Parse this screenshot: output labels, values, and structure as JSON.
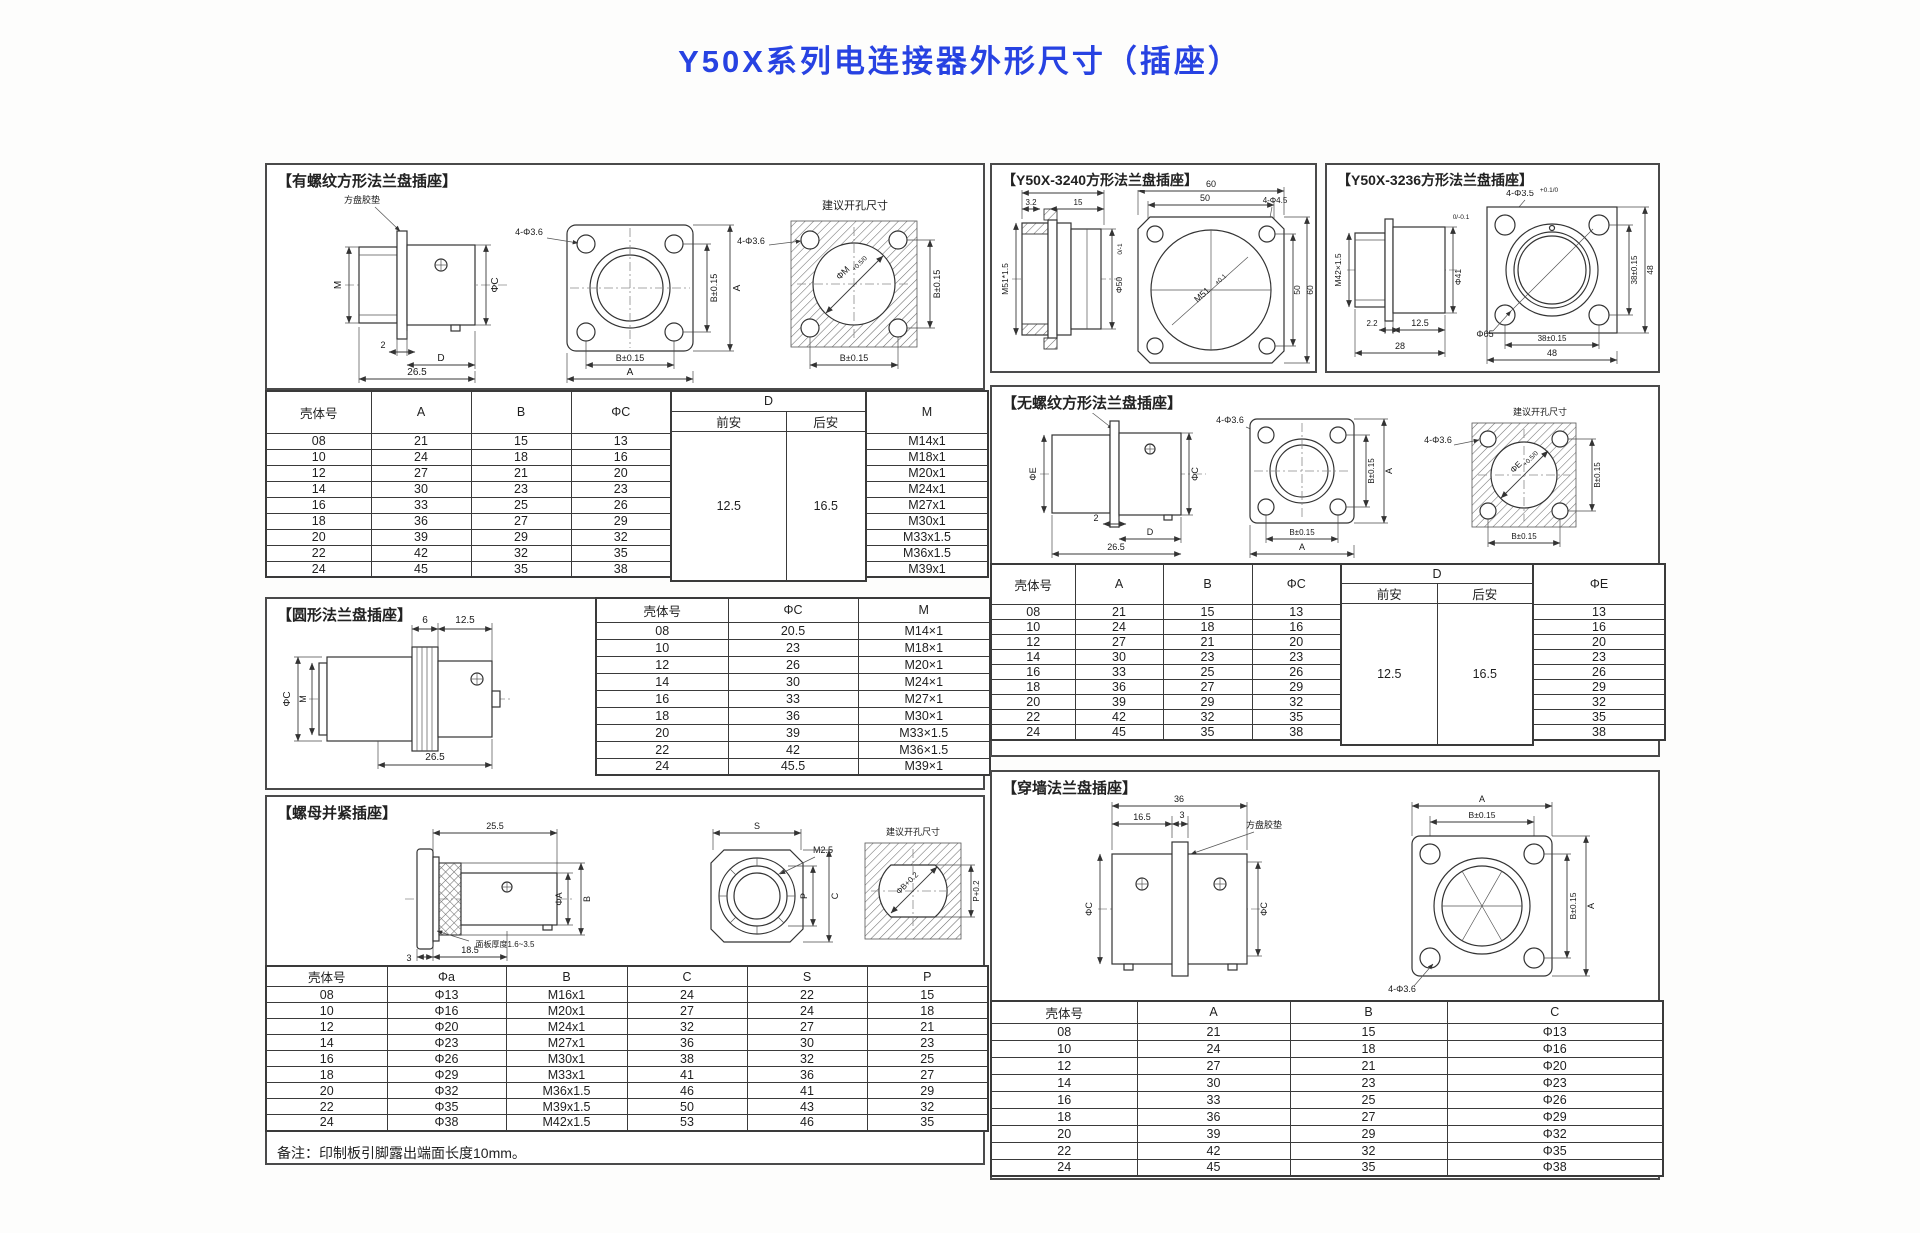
{
  "page": {
    "title": "Y50X系列电连接器外形尺寸（插座）"
  },
  "threaded": {
    "title": "【有螺纹方形法兰盘插座】",
    "draw": {
      "gasket": "方盘胶垫",
      "m": "M",
      "phiC": "ΦC",
      "dim2": "2",
      "d": "D",
      "dim265": "26.5",
      "holes": "4-Φ3.6",
      "b": "B±0.15",
      "a": "A",
      "suggest": "建议开孔尺寸",
      "phiM": "ΦM",
      "phiM_tol": "+0.5/0"
    },
    "tbl": {
      "shell": "壳体号",
      "a": "A",
      "b": "B",
      "phiC": "ΦC",
      "d": "D",
      "front": "前安",
      "rear": "后安",
      "m": "M",
      "rows": [
        [
          "08",
          "21",
          "15",
          "13"
        ],
        [
          "10",
          "24",
          "18",
          "16"
        ],
        [
          "12",
          "27",
          "21",
          "20"
        ],
        [
          "14",
          "30",
          "23",
          "23"
        ],
        [
          "16",
          "33",
          "25",
          "26"
        ],
        [
          "18",
          "36",
          "27",
          "29"
        ],
        [
          "20",
          "39",
          "29",
          "32"
        ],
        [
          "22",
          "42",
          "32",
          "35"
        ],
        [
          "24",
          "45",
          "35",
          "38"
        ]
      ],
      "m_rows": [
        [
          "M14x1"
        ],
        [
          "M18x1"
        ],
        [
          "M20x1"
        ],
        [
          "M24x1"
        ],
        [
          "M27x1"
        ],
        [
          "M30x1"
        ],
        [
          "M33x1.5"
        ],
        [
          "M36x1.5"
        ],
        [
          "M39x1"
        ]
      ],
      "d_front": "12.5",
      "d_rear": "16.5"
    }
  },
  "circular": {
    "title": "【圆形法兰盘插座】",
    "draw": {
      "dim6": "6",
      "dim125": "12.5",
      "phiC": "ΦC",
      "m": "M",
      "dim265": "26.5"
    },
    "tbl": {
      "headers": [
        "壳体号",
        "ΦC",
        "M"
      ],
      "rows": [
        [
          "08",
          "20.5",
          "M14×1"
        ],
        [
          "10",
          "23",
          "M18×1"
        ],
        [
          "12",
          "26",
          "M20×1"
        ],
        [
          "14",
          "30",
          "M24×1"
        ],
        [
          "16",
          "33",
          "M27×1"
        ],
        [
          "18",
          "36",
          "M30×1"
        ],
        [
          "20",
          "39",
          "M33×1.5"
        ],
        [
          "22",
          "42",
          "M36×1.5"
        ],
        [
          "24",
          "45.5",
          "M39×1"
        ]
      ]
    }
  },
  "nut": {
    "title": "【螺母并紧插座】",
    "draw": {
      "dim255": "25.5",
      "phiA": "ΦA",
      "b": "B",
      "panel": "面板厚度1.6~3.5",
      "dim3": "3",
      "dim185": "18.5",
      "s": "S",
      "m25": "M2.5",
      "p": "P",
      "c": "C",
      "suggest": "建议开孔尺寸",
      "phiB": "ΦB+0.2",
      "p02": "P+0.2"
    },
    "tbl": {
      "headers": [
        "壳体号",
        "Φa",
        "B",
        "C",
        "S",
        "P"
      ],
      "rows": [
        [
          "08",
          "Φ13",
          "M16x1",
          "24",
          "22",
          "15"
        ],
        [
          "10",
          "Φ16",
          "M20x1",
          "27",
          "24",
          "18"
        ],
        [
          "12",
          "Φ20",
          "M24x1",
          "32",
          "27",
          "21"
        ],
        [
          "14",
          "Φ23",
          "M27x1",
          "36",
          "30",
          "23"
        ],
        [
          "16",
          "Φ26",
          "M30x1",
          "38",
          "32",
          "25"
        ],
        [
          "18",
          "Φ29",
          "M33x1",
          "41",
          "36",
          "27"
        ],
        [
          "20",
          "Φ32",
          "M36x1.5",
          "46",
          "41",
          "29"
        ],
        [
          "22",
          "Φ35",
          "M39x1.5",
          "50",
          "43",
          "32"
        ],
        [
          "24",
          "Φ38",
          "M42x1.5",
          "53",
          "46",
          "35"
        ]
      ]
    },
    "note": "备注：印制板引脚露出端面长度10mm。"
  },
  "y3240": {
    "title": "【Y50X-3240方形法兰盘插座】",
    "draw": {
      "dim32": "32",
      "dim32a": "3.2",
      "dim15": "15",
      "m51s": "M51*1.5",
      "phi50": "Φ50",
      "phi50_tol": "0/-1",
      "dim60": "60",
      "dim50": "50",
      "holes": "4-Φ4.5",
      "m51": "M51",
      "m51_tol": "+0.1",
      "dim50b": "50",
      "dim60b": "60"
    }
  },
  "y3236": {
    "title": "【Y50X-3236方形法兰盘插座】",
    "draw": {
      "m42": "M42×1.5",
      "phi41": "Φ41",
      "phi41_tol": "0/-0.1",
      "dim22": "2.2",
      "dim125": "12.5",
      "dim28": "28",
      "holes": "4-Φ3.5",
      "holes_tol": "+0.1/0",
      "phi65": "Φ65",
      "b38": "38±0.15",
      "dim48": "48"
    }
  },
  "unthreaded": {
    "title": "【无螺纹方形法兰盘插座】",
    "draw": {
      "gasket": "方盘胶垫",
      "phiE": "ΦE",
      "phiC": "ΦC",
      "dim2": "2",
      "d": "D",
      "dim265": "26.5",
      "holes": "4-Φ3.6",
      "b": "B±0.15",
      "a": "A",
      "suggest": "建议开孔尺寸",
      "phiEd": "ΦE",
      "phiE_tol": "+0.5/0"
    },
    "tbl": {
      "shell": "壳体号",
      "a": "A",
      "b": "B",
      "phiC": "ΦC",
      "d": "D",
      "front": "前安",
      "rear": "后安",
      "phiE": "ΦE",
      "rows": [
        [
          "08",
          "21",
          "15",
          "13"
        ],
        [
          "10",
          "24",
          "18",
          "16"
        ],
        [
          "12",
          "27",
          "21",
          "20"
        ],
        [
          "14",
          "30",
          "23",
          "23"
        ],
        [
          "16",
          "33",
          "25",
          "26"
        ],
        [
          "18",
          "36",
          "27",
          "29"
        ],
        [
          "20",
          "39",
          "29",
          "32"
        ],
        [
          "22",
          "42",
          "32",
          "35"
        ],
        [
          "24",
          "45",
          "35",
          "38"
        ]
      ],
      "e_rows": [
        [
          "13"
        ],
        [
          "16"
        ],
        [
          "20"
        ],
        [
          "23"
        ],
        [
          "26"
        ],
        [
          "29"
        ],
        [
          "32"
        ],
        [
          "35"
        ],
        [
          "38"
        ]
      ],
      "d_front": "12.5",
      "d_rear": "16.5"
    }
  },
  "throughwall": {
    "title": "【穿墙法兰盘插座】",
    "draw": {
      "dim36": "36",
      "dim165": "16.5",
      "dim3": "3",
      "gasket": "方盘胶垫",
      "phiC": "ΦC",
      "a": "A",
      "b": "B±0.15",
      "holes": "4-Φ3.6"
    },
    "tbl": {
      "headers": [
        "壳体号",
        "A",
        "B",
        "C"
      ],
      "rows": [
        [
          "08",
          "21",
          "15",
          "Φ13"
        ],
        [
          "10",
          "24",
          "18",
          "Φ16"
        ],
        [
          "12",
          "27",
          "21",
          "Φ20"
        ],
        [
          "14",
          "30",
          "23",
          "Φ23"
        ],
        [
          "16",
          "33",
          "25",
          "Φ26"
        ],
        [
          "18",
          "36",
          "27",
          "Φ29"
        ],
        [
          "20",
          "39",
          "29",
          "Φ32"
        ],
        [
          "22",
          "42",
          "32",
          "Φ35"
        ],
        [
          "24",
          "45",
          "35",
          "Φ38"
        ]
      ]
    }
  }
}
